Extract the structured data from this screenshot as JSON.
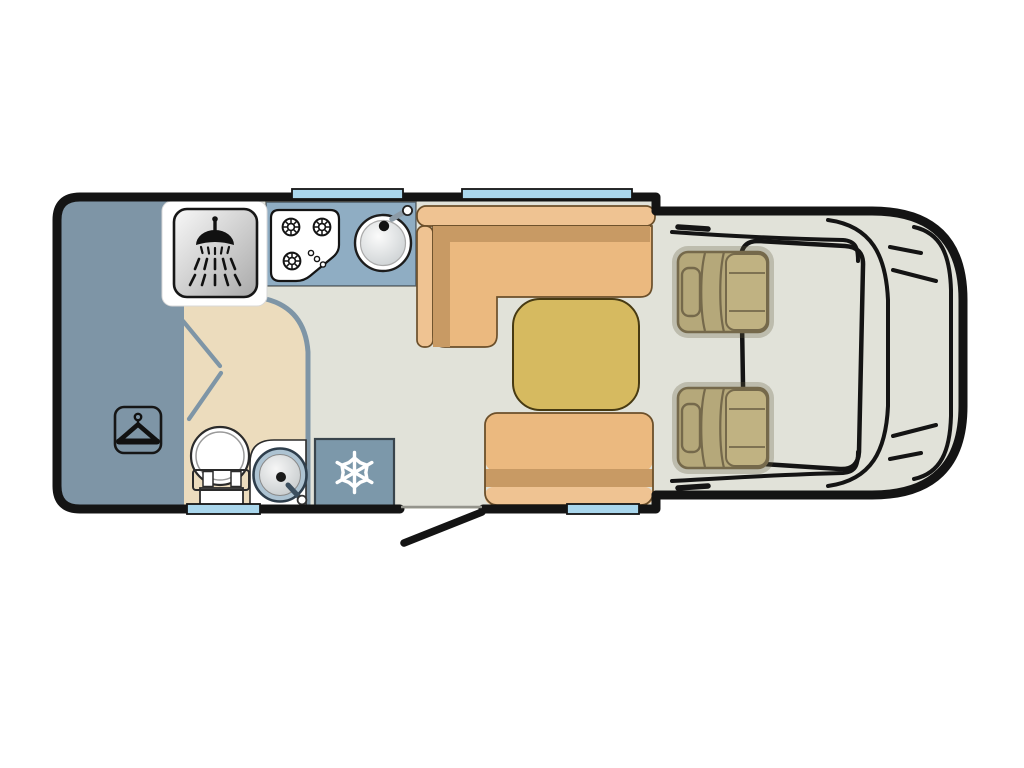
{
  "meta": {
    "title": "Motorhome floor plan (top-down view, cab at right)",
    "diagram_type": "vehicle-floorplan"
  },
  "labels": {
    "vehicle": "Motorhome body",
    "bed": "Rear bed / lounge area",
    "wardrobe": "Wardrobe (clothes hanger symbol)",
    "shower": "Shower cubicle",
    "bathroom": "Washroom",
    "bathroom_door": "Washroom door (open)",
    "toilet": "Toilet",
    "basin": "Washbasin with tap",
    "kitchen": "Kitchen worktop",
    "hob": "Three-burner gas hob",
    "sink": "Kitchen sink with tap",
    "fridge": "Fridge / freezer (snowflake symbol)",
    "sofa": "L-shaped lounge seating",
    "table": "Dinette table",
    "bench": "Forward-facing travel seat",
    "entry_door": "Entry door (shown open)",
    "threshold": "Entry doorway",
    "window_kitchen": "Window (kitchen side)",
    "window_lounge": "Window (lounge side)",
    "window_washroom": "Window (washroom side)",
    "window_bench": "Window (bench side)",
    "cab": "Driving cab",
    "windscreen": "Windscreen",
    "cab_seat_top": "Cab swivel seat (passenger)",
    "cab_seat_bottom": "Cab swivel seat (driver)",
    "mirror_top": "Door mirror",
    "mirror_bottom": "Door mirror",
    "bonnet_lines": "Bonnet / front body contour lines"
  },
  "icons": [
    "shower-icon",
    "hanger-icon",
    "snowflake-icon",
    "burner-icon",
    "sink-icon",
    "toilet-icon",
    "basin-icon"
  ],
  "colors": {
    "floor": "#e1e2d9",
    "wall": "#141414",
    "slate": "#7e95a6",
    "counter": "#8fadc3",
    "fridge": "#7c98aa",
    "beige": "#ecdcbd",
    "window": "#a9d6ec",
    "tanLight": "#efc392",
    "tanMid": "#ebb97f",
    "tanDark": "#c89a64",
    "sofaLine": "#6b4f2a",
    "table": "#d6ba60",
    "tableLine": "#473a12",
    "khaki": "#b5a87a",
    "khakiLight": "#c0b282",
    "khakiDark": "#75694b",
    "white": "#ffffff"
  }
}
